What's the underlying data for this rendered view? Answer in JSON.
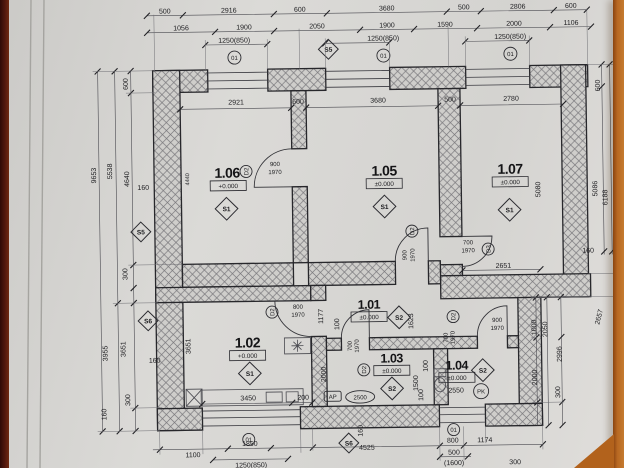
{
  "plan": {
    "top_row1": [
      "500",
      "2916",
      "600",
      "3680",
      "500",
      "2806",
      "600"
    ],
    "top_row2": [
      "1056",
      "1900",
      "2050",
      "1900",
      "1590",
      "2000",
      "1106"
    ],
    "top_row3": [
      "1250(850)",
      "1250(850)",
      "1250(850)"
    ],
    "win_mark": "01",
    "top_s5": "S5",
    "interior_top": [
      "2921",
      "600",
      "3680",
      "500",
      "2780"
    ],
    "left": {
      "d600": "600",
      "d5538": "5538",
      "d4640": "4640",
      "d9653": "9653",
      "d160a": "160",
      "d300a": "300",
      "d3955": "3955",
      "d3651": "3651",
      "d300b": "300",
      "d160b": "160",
      "d160c": "160",
      "s5": "S5",
      "s6": "S6"
    },
    "right": {
      "d600": "600",
      "d5086": "5086",
      "d6188": "6188",
      "d160": "160",
      "d2657": "2657",
      "d1000": "1000",
      "d2050": "2050",
      "d2996": "2996",
      "d2000": "2000",
      "d300": "300"
    },
    "bottom": {
      "d1100": "1100",
      "d1850": "1850",
      "d1250": "1250(850)",
      "d4525": "4525",
      "d160": "160",
      "d800": "800",
      "d1174": "1174",
      "d500": "500",
      "d1600": "(1600)",
      "d300": "300",
      "s6": "S6"
    },
    "rooms": {
      "r106": {
        "id": "1.06",
        "level": "+0.000",
        "mark": "S1",
        "h": "4440"
      },
      "r105": {
        "id": "1.05",
        "level": "±0.000",
        "mark": "S1"
      },
      "r107": {
        "id": "1.07",
        "level": "±0.000",
        "mark": "S1",
        "h": "5080",
        "d2651": "2651"
      },
      "r101": {
        "id": "1.01",
        "level": "±0.000",
        "mark": "S2",
        "d1177": "1177",
        "d100": "100",
        "d1623": "1623"
      },
      "r102": {
        "id": "1.02",
        "level": "+0.000",
        "mark": "S1",
        "d3651": "3651",
        "d3450": "3450",
        "d200": "200"
      },
      "r103": {
        "id": "1.03",
        "level": "±0.000",
        "mark": "S2",
        "d2000": "2000",
        "ap": "AP",
        "rad": "2500"
      },
      "r104": {
        "id": "1.04",
        "level": "±0.000",
        "mark": "S2",
        "d2550": "2550",
        "pk": "PK",
        "d1500": "1500",
        "d100a": "100",
        "d100b": "100"
      }
    },
    "doors": {
      "k106": {
        "mark": "D2",
        "w": "900",
        "h": "1970"
      },
      "k102": {
        "mark": "D2",
        "w": "800",
        "h": "1970"
      },
      "k105": {
        "mark": "D2",
        "w": "900",
        "h": "1970"
      },
      "k107": {
        "mark": "D3",
        "w": "700",
        "h": "1970"
      },
      "k103": {
        "mark": "D2",
        "w": "700",
        "h": "1970"
      },
      "k104": {
        "mark": "D2",
        "w": "900",
        "h": "1970"
      },
      "k104b": {
        "w": "700",
        "h": "1970"
      }
    }
  }
}
